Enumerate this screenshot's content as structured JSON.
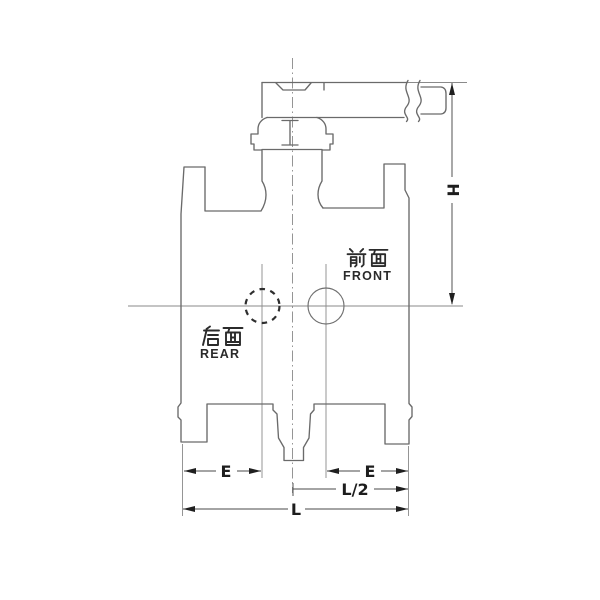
{
  "title": "valve-outline-dimension-drawing",
  "labels": {
    "front_cn": "前面",
    "front_en": "FRONT",
    "rear_cn": "后面",
    "rear_en": "REAR"
  },
  "dimensions": {
    "h": "H",
    "e_left": "E",
    "e_right": "E",
    "l_half": "L/2",
    "l": "L"
  },
  "features": {
    "front_port": "solid-circle",
    "rear_port": "dashed-circle",
    "handle_break": "long-break-symbol"
  },
  "colors": {
    "background": "#ffffff",
    "outline": "#6a6a6a",
    "dimension_line": "#4a4a4a",
    "text": "#1d1d1d"
  }
}
